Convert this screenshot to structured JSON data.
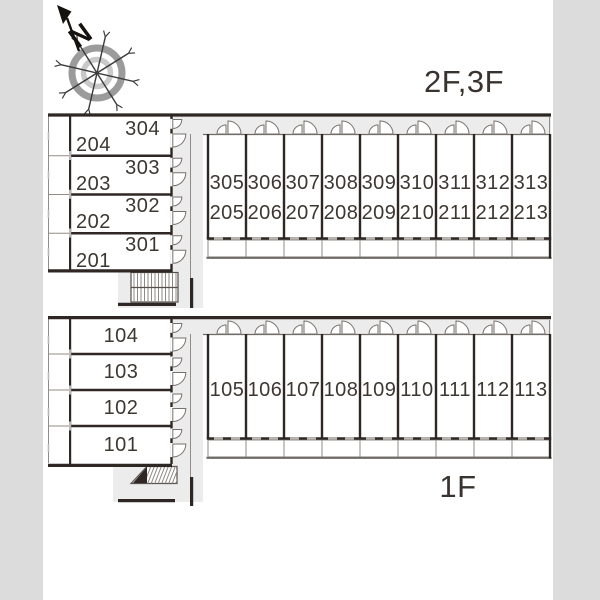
{
  "compass": {
    "north_label": "N"
  },
  "floor_labels": {
    "upper": "2F,3F",
    "lower": "1F"
  },
  "upper_plan": {
    "side_rooms": [
      {
        "floor3": "304",
        "floor2": "204"
      },
      {
        "floor3": "303",
        "floor2": "203"
      },
      {
        "floor3": "302",
        "floor2": "202"
      },
      {
        "floor3": "301",
        "floor2": "201"
      }
    ],
    "row_rooms": [
      {
        "floor3": "305",
        "floor2": "205"
      },
      {
        "floor3": "306",
        "floor2": "206"
      },
      {
        "floor3": "307",
        "floor2": "207"
      },
      {
        "floor3": "308",
        "floor2": "208"
      },
      {
        "floor3": "309",
        "floor2": "209"
      },
      {
        "floor3": "310",
        "floor2": "210"
      },
      {
        "floor3": "311",
        "floor2": "211"
      },
      {
        "floor3": "312",
        "floor2": "212"
      },
      {
        "floor3": "313",
        "floor2": "213"
      }
    ]
  },
  "lower_plan": {
    "side_rooms": [
      "104",
      "103",
      "102",
      "101"
    ],
    "row_rooms": [
      "105",
      "106",
      "107",
      "108",
      "109",
      "110",
      "111",
      "112",
      "113"
    ]
  },
  "colors": {
    "page_bg": "#dcdcdc",
    "sheet_bg": "#ffffff",
    "wall": "#2e2724",
    "corridor_fill": "#ececec",
    "thin_line": "#918c87",
    "label_text": "#3d3732"
  }
}
